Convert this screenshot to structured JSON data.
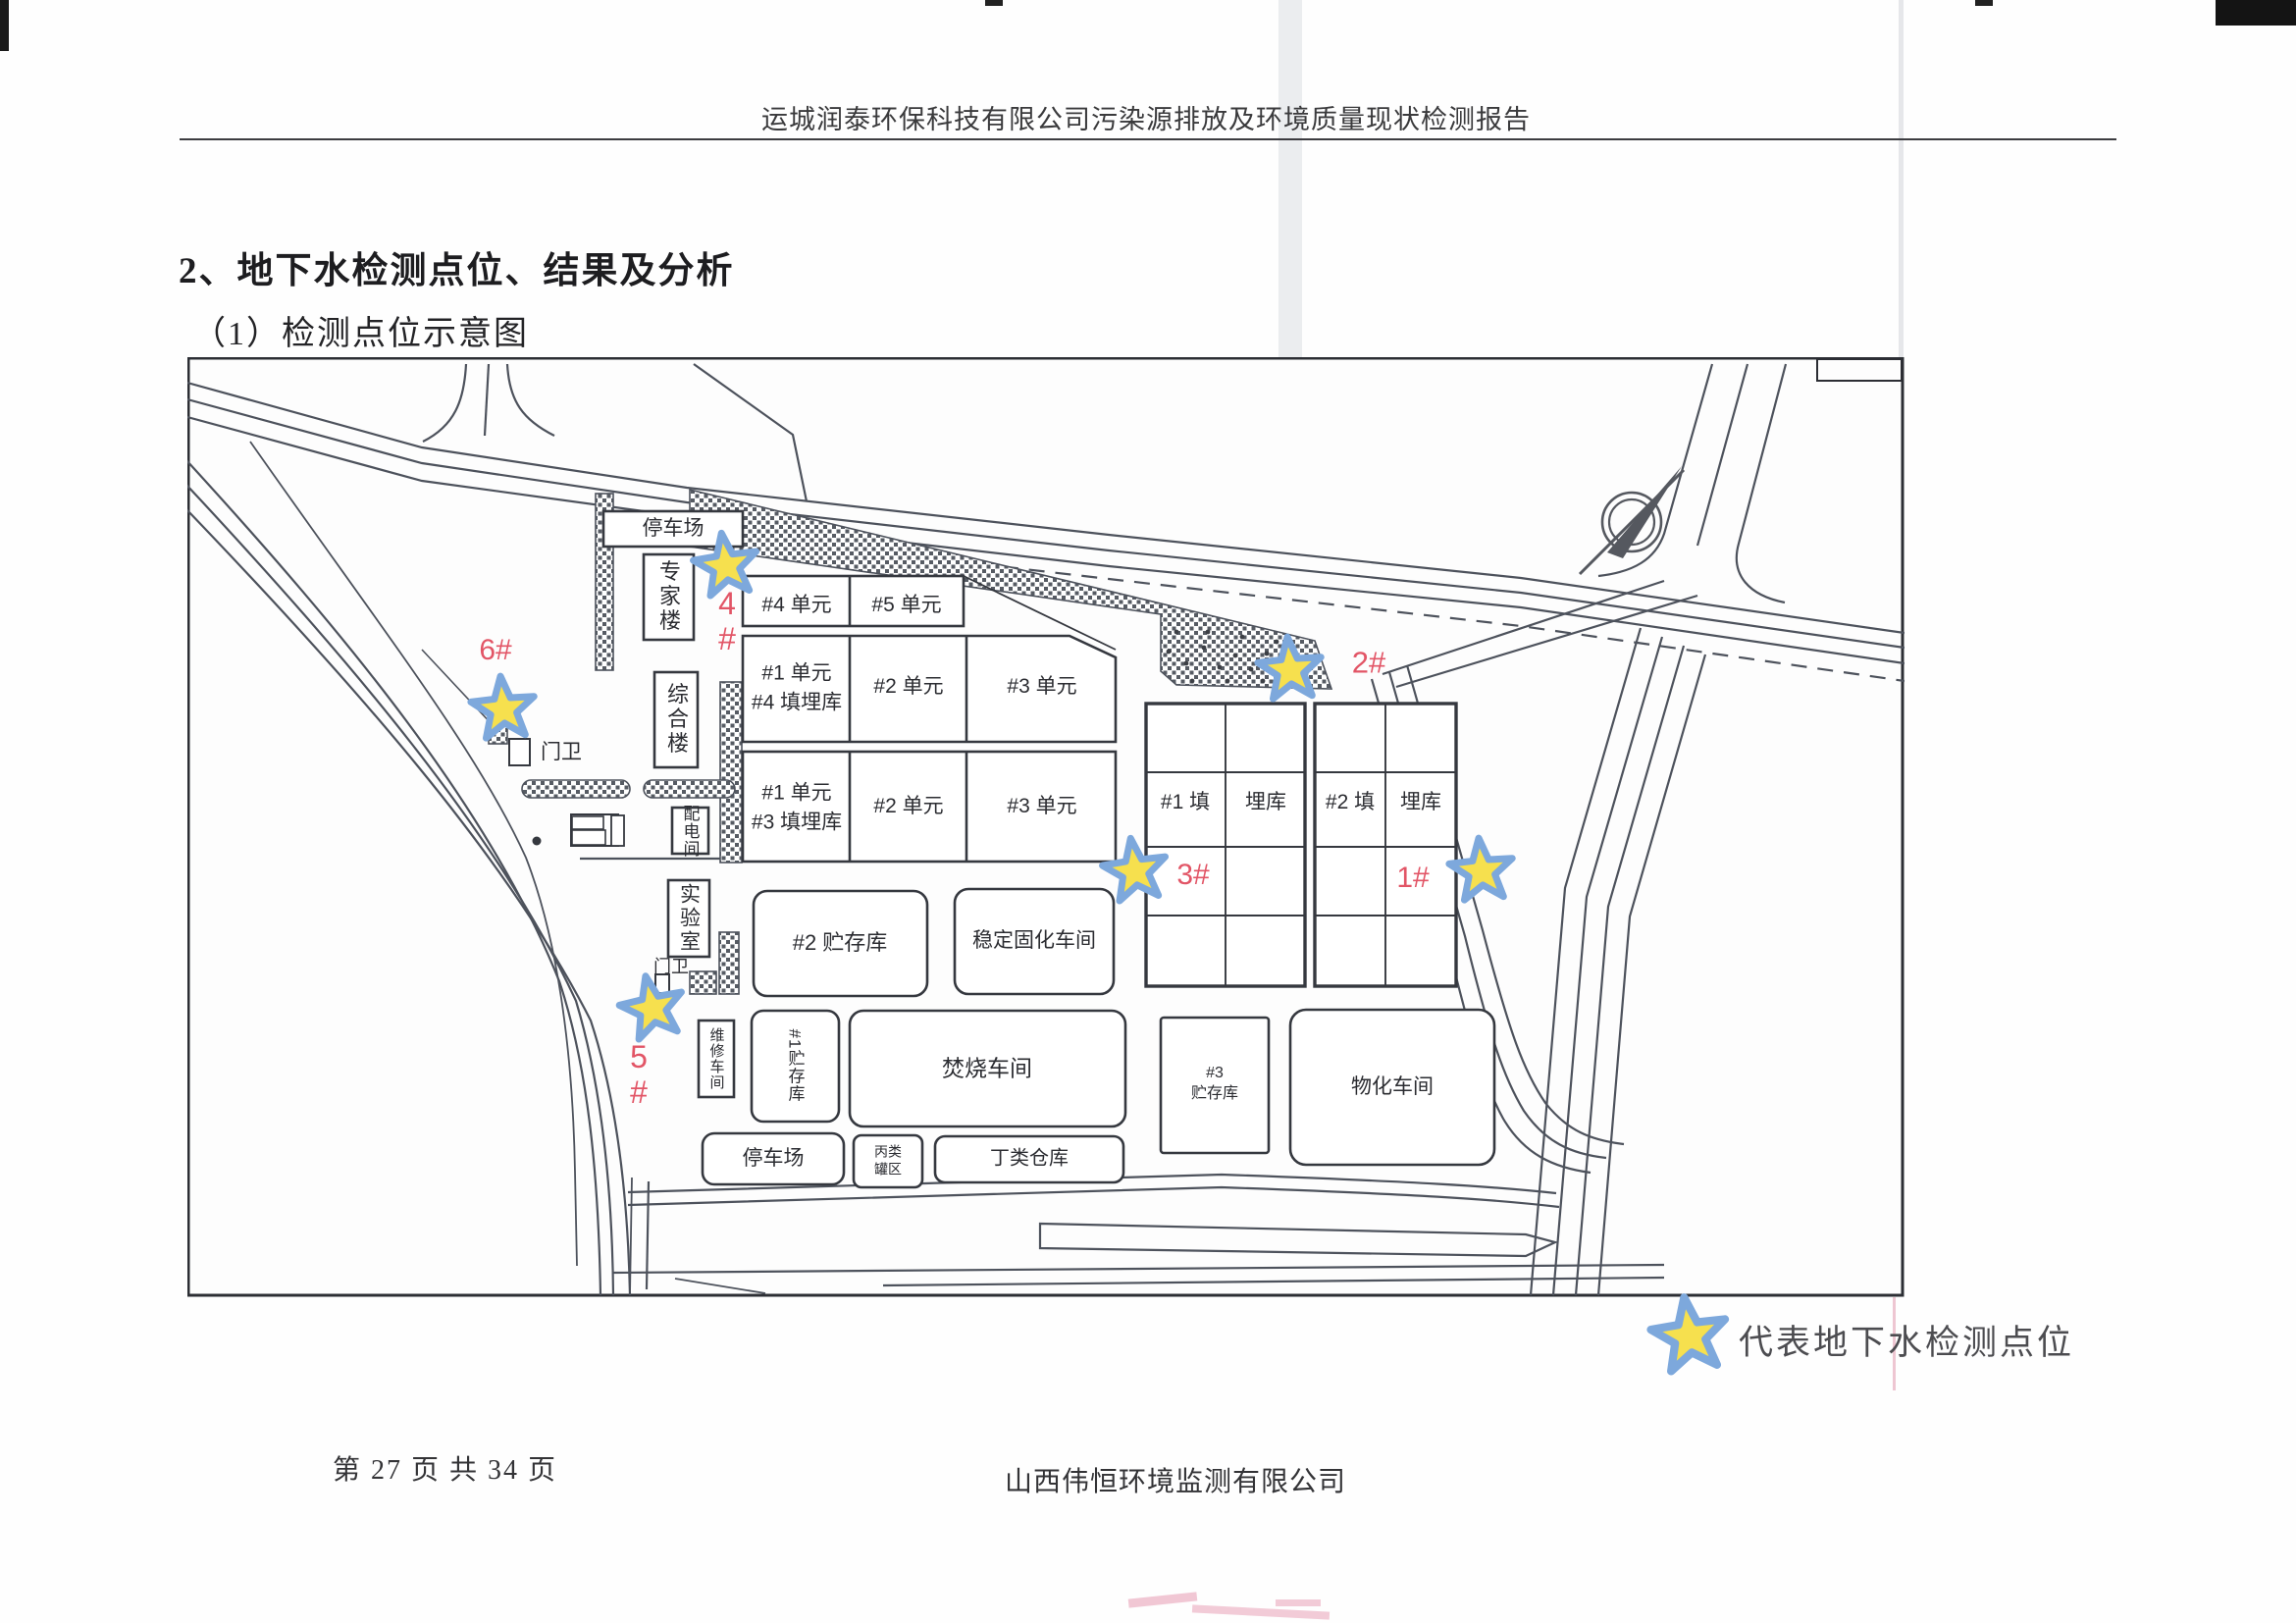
{
  "page": {
    "header": "运城润泰环保科技有限公司污染源排放及环境质量现状检测报告",
    "section_title": "2、地下水检测点位、结果及分析",
    "section_subtitle": "（1）检测点位示意图",
    "footer_left": "第 27 页 共 34 页",
    "footer_center": "山西伟恒环境监测有限公司"
  },
  "legend": {
    "text": "代表地下水检测点位"
  },
  "map": {
    "buildings": {
      "parking_top": "停车场",
      "expert_building": "专家楼",
      "comprehensive_building": "综合楼",
      "power_distribution_room": "配电间",
      "laboratory": "实验室",
      "gate_upper": "门卫",
      "gate_lower": "门卫",
      "maintenance_workshop": "维修车间",
      "storage_1": "#1贮存库",
      "storage_2": "#2 贮存库",
      "storage_3": "#3\n贮存库",
      "stabilization_workshop": "稳定固化车间",
      "incineration_workshop": "焚烧车间",
      "physchem_workshop": "物化车间",
      "parking_bottom": "停车场",
      "class_c_tank_area": "丙类\n罐区",
      "class_d_warehouse": "丁类仓库"
    },
    "landfill_units": {
      "row1": [
        "#4 单元",
        "#5 单元"
      ],
      "row2": [
        "#1 单元\n#4 填埋库",
        "#2 单元",
        "#3 单元"
      ],
      "row3": [
        "#1 单元\n#3 填埋库",
        "#2 单元",
        "#3 单元"
      ]
    },
    "landfill_cells": [
      "#1 填",
      "埋库",
      "#2 填",
      "埋库"
    ],
    "monitoring_points": [
      {
        "id": "1#",
        "label": "1#"
      },
      {
        "id": "2#",
        "label": "2#"
      },
      {
        "id": "3#",
        "label": "3#"
      },
      {
        "id": "4#",
        "label": "4\n#"
      },
      {
        "id": "5#",
        "label": "5\n#"
      },
      {
        "id": "6#",
        "label": "6#"
      }
    ]
  },
  "colors": {
    "star_fill": "#f6e04e",
    "star_stroke": "#7da8dc",
    "point_label": "#e25566",
    "road_line": "#4d525c",
    "building_line": "#35383f",
    "text": "#2e2f33"
  }
}
